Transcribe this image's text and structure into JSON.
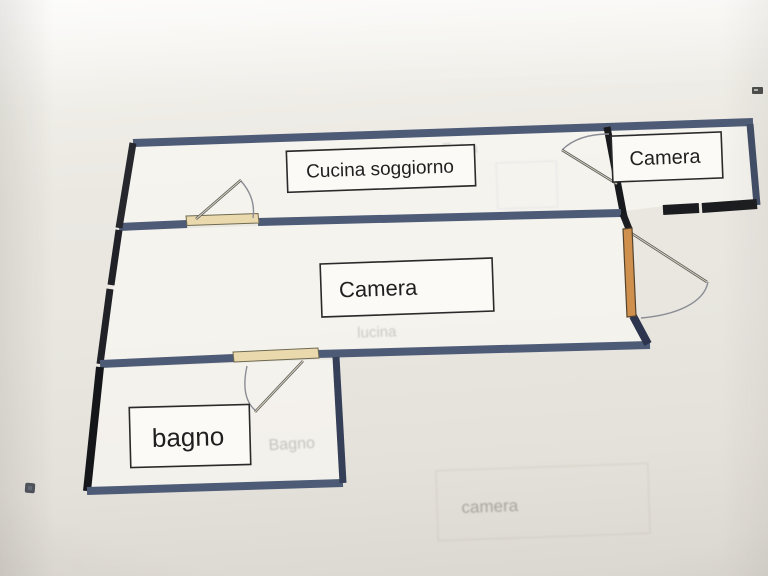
{
  "labels": {
    "room1": "Cucina soggiorno",
    "room2": "Camera",
    "room3": "Camera",
    "room4": "bagno"
  },
  "ghosts": {
    "g1": "Entra",
    "g2": "lucina",
    "g3": "Bagno",
    "g4": "camera"
  },
  "colors": {
    "wall_blue": "#4e5b76",
    "wall_black": "#1b1c1f",
    "door_orange": "#cf8f4d",
    "door_sill_beige": "#ead9ad",
    "paper": "#eae7e1",
    "label_ink": "#1f1f1f"
  }
}
